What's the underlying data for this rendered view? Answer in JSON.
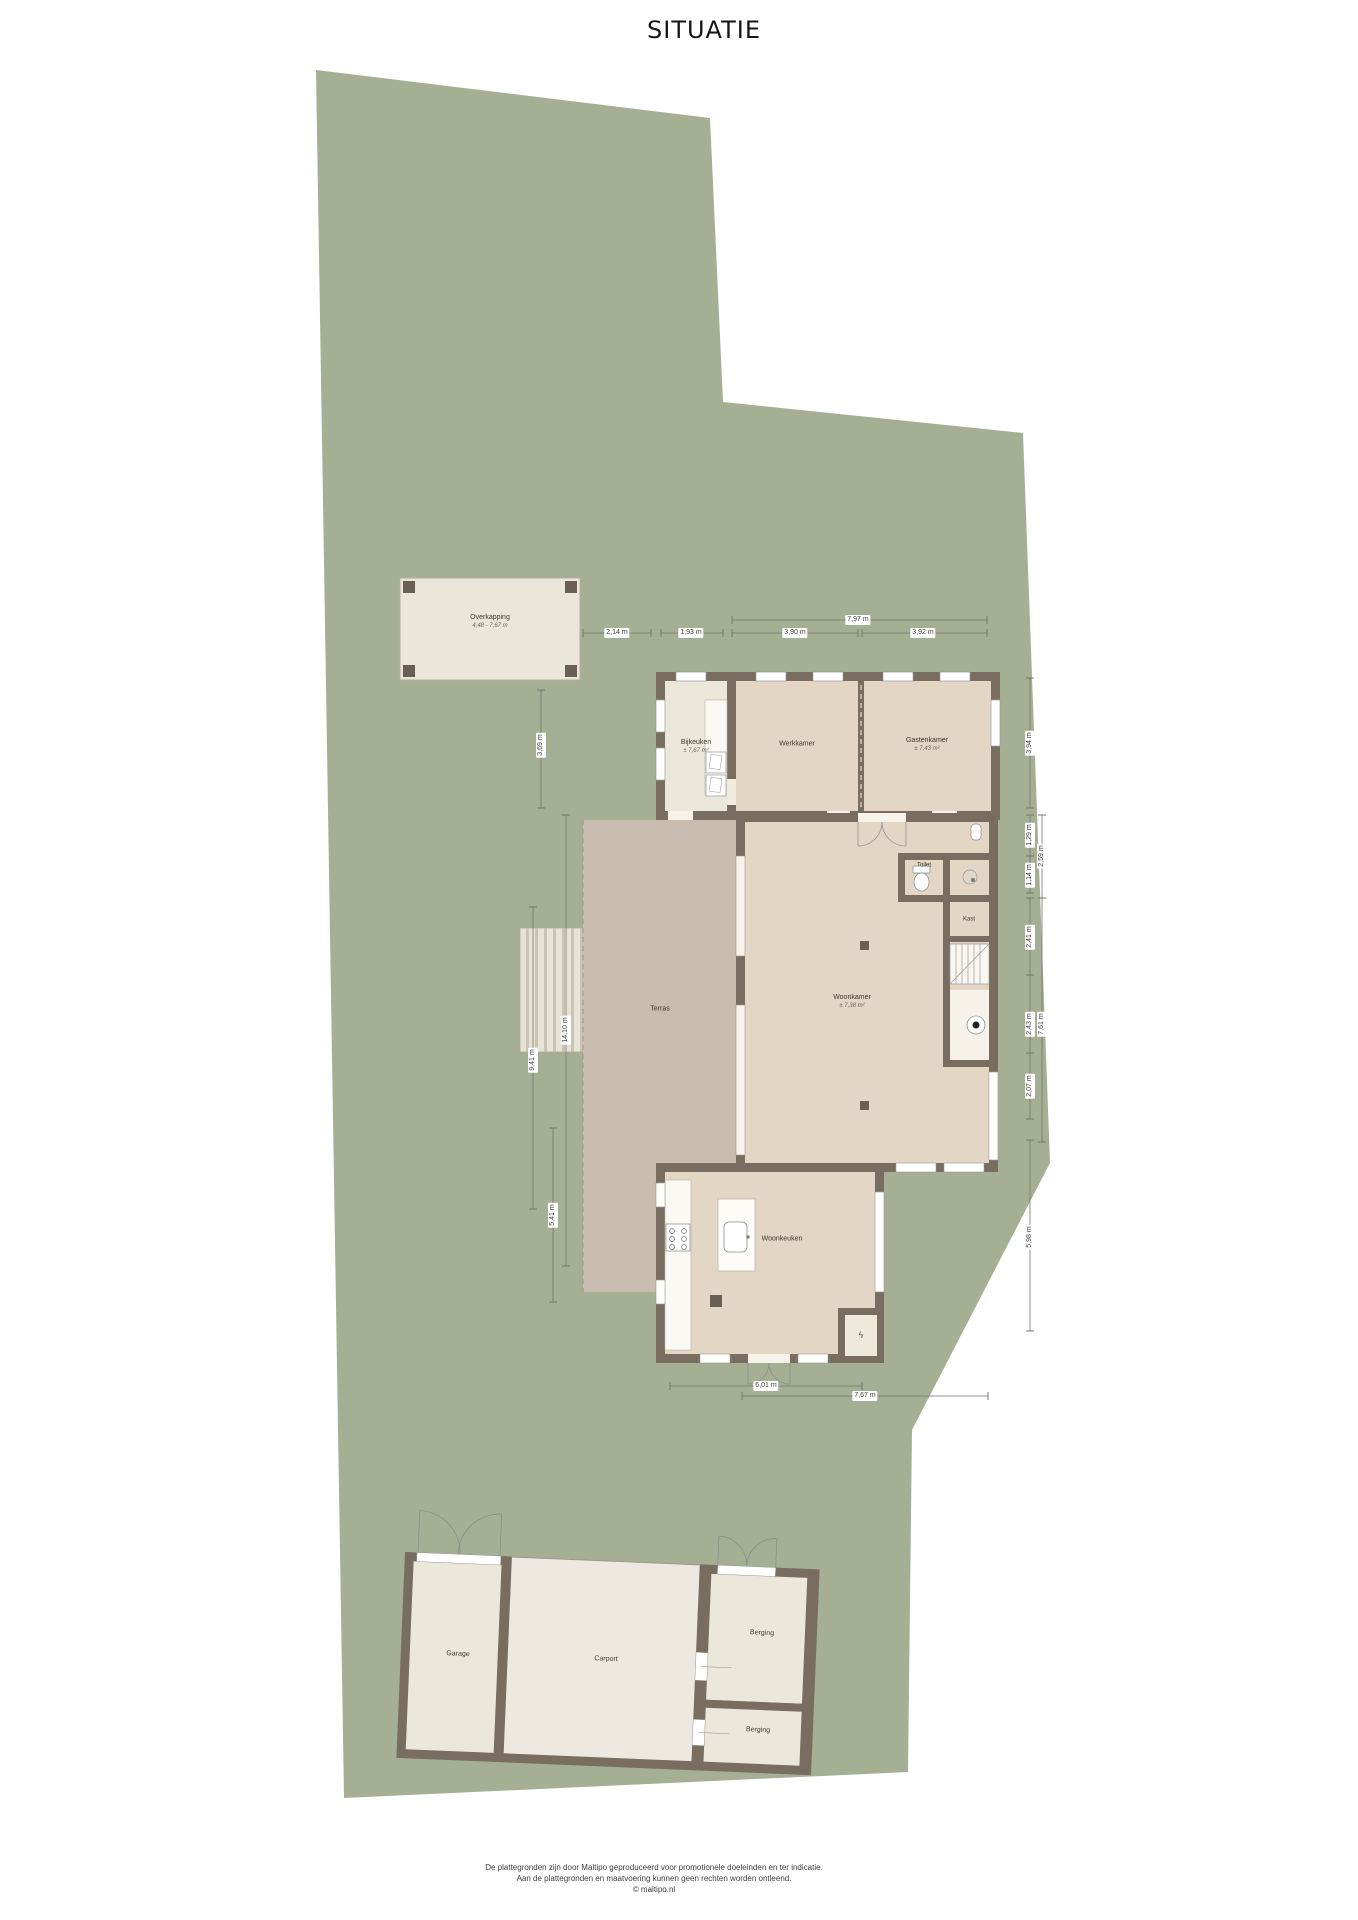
{
  "title": "SITUATIE",
  "rooms": {
    "overkapping": {
      "label": "Overkapping",
      "sub": "4,48 - 7,67 m"
    },
    "bijkeuken": {
      "label": "Bijkeuken",
      "sub": "± 7,67 m²"
    },
    "werkkamer": {
      "label": "Werkkamer"
    },
    "gastenkamer": {
      "label": "Gastenkamer",
      "sub": "± 7,43 m²"
    },
    "toilet": {
      "label": "Toilet"
    },
    "kast": {
      "label": "Kast"
    },
    "woonkamer": {
      "label": "Woonkamer",
      "sub": "± 7,38 m²"
    },
    "terras": {
      "label": "Terras"
    },
    "woonkeuken": {
      "label": "Woonkeuken"
    },
    "garage": {
      "label": "Garage"
    },
    "carport": {
      "label": "Carport"
    },
    "berging_1": {
      "label": "Berging"
    },
    "berging_2": {
      "label": "Berging"
    }
  },
  "dimensions": {
    "top_total": "7,97 m",
    "top_1": "2,14 m",
    "top_2": "1,93 m",
    "top_3": "3,90 m",
    "top_4": "3,92 m",
    "left_1": "3,69 m",
    "left_2": "14,10 m",
    "left_3": "9,41 m",
    "left_4": "5,41 m",
    "right_1": "3,94 m",
    "right_2": "1,29 m",
    "right_3": "2,59 m",
    "right_4": "1,14 m",
    "right_5": "2,41 m",
    "right_6": "2,43 m",
    "right_7": "7,61 m",
    "right_8": "2,07 m",
    "right_9": "5,98 m",
    "bottom_1": "6,01 m",
    "bottom_2": "7,67 m"
  },
  "icons": {
    "electric": "ϟ"
  },
  "colors": {
    "plot_green": "#a5af93",
    "wall": "#796d5f",
    "room_beige": "#e3d6c4",
    "room_cream": "#ece7db",
    "terras": "#c8bdae"
  },
  "footer": {
    "line1": "De plattegronden zijn door Maltipo geproduceerd voor promotionele doeleinden en ter indicatie.",
    "line2": "Aan de plattegronden en maatvoering kunnen geen rechten worden ontleend.",
    "line3": "© maltipo.nl"
  }
}
